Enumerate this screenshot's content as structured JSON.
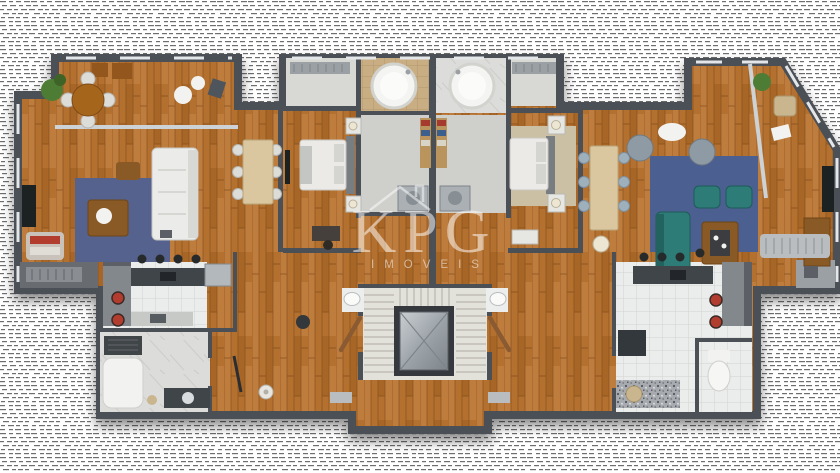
{
  "watermark": {
    "brand": "KPG",
    "subtitle": "IMOVEIS",
    "icon": "house-outline-icon"
  },
  "colors": {
    "background": "#ffffff",
    "wood": "#b4702e",
    "wood_light": "#c98a49",
    "wood_dark": "#93571f",
    "wood_seam": "#7e4a1a",
    "wall": "#4b5056",
    "wall_light": "#e4e7e9",
    "glass": "#ccd2d5",
    "tile_white": "#ebecec",
    "tile_line": "#d2d3d1",
    "tile_tan": "#c9ae84",
    "tan_line": "#b2986c",
    "marble": "#dcdcda",
    "marble_vein": "#cacac8",
    "floor_gray": "#cfd0cc",
    "closet_floor": "#d8d8d4",
    "rug_left": "#54628d",
    "rug_right": "#4b5e91",
    "sofa_white": "#ebebe9",
    "sofa_shadow": "#c6c6c2",
    "teal": "#2e7b77",
    "teal_dark": "#1f5c59",
    "beige_table": "#dac79f",
    "chair_gray": "#9fb0bd",
    "bed_white": "#eceae6",
    "headboard": "#787d81",
    "bed_rug": "#cbbfa4",
    "counter_dark": "#3f444a",
    "counter_gray": "#83888c",
    "granite": "#a7abaf",
    "stool_black": "#27292b",
    "stool_red": "#b23c2e",
    "stairs": "#e3e2da",
    "stair_line": "#b7b6ae",
    "elevator_frame": "#34383c",
    "door": "#8a5a30",
    "plant": "#4e7d35",
    "lamp": "#ece6d2",
    "tv_black": "#1e2022",
    "washer": "#aab0b4",
    "balcony_dark": "#686c70",
    "watermark": "#ffffff"
  }
}
